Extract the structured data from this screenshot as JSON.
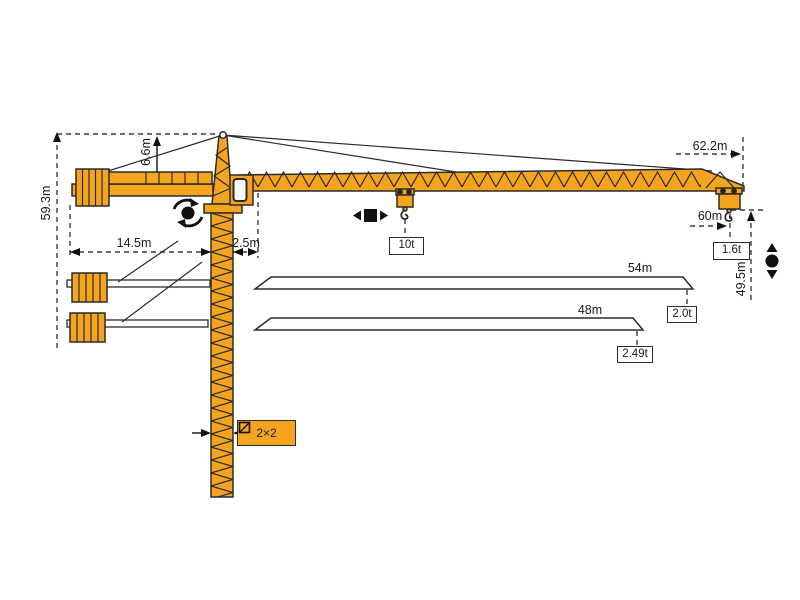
{
  "diagram": {
    "labels": {
      "total_height": "59.3m",
      "tower_head_height": "6.6m",
      "counter_jib_radius": "14.5m",
      "rear_offset": "2.5m",
      "max_jib_radius": "62.2m",
      "tip_hook_radius": "60m",
      "hook_height": "49.5m",
      "jib_option_54": "54m",
      "jib_option_48": "48m",
      "max_capacity": "10t",
      "tip_capacity_60m": "1.6t",
      "tip_capacity_54m": "2.0t",
      "tip_capacity_48m": "2.49t",
      "mast_section": "2×2"
    },
    "icons": {
      "slewing": "rotation-dot-with-arc-arrows",
      "trolley_travel": "black-square-with-left-right-arrows",
      "hoist": "black-dot-with-up-down-arrows",
      "mast_section": "square-with-diagonal"
    },
    "colors": {
      "crane_fill": "#F5A41F",
      "outline": "#2B2B2B",
      "dimension_line": "#3A3A3A",
      "background": "#FFFFFF"
    }
  }
}
